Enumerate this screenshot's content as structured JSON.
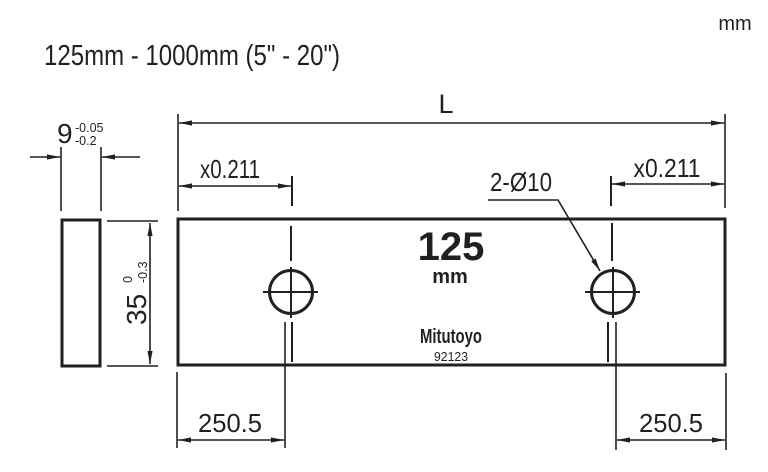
{
  "header": {
    "range_title": "125mm - 1000mm (5\" - 20\")",
    "unit_label": "mm"
  },
  "drawing": {
    "length_label": "L",
    "offset_left": "x0.211",
    "offset_right": "x0.211",
    "hole_callout": "2-Ø10",
    "hole_dist_left": "250.5",
    "hole_dist_right": "250.5",
    "thickness": {
      "value": "9",
      "tol_upper": "-0.05",
      "tol_lower": "-0.2"
    },
    "height": {
      "value": "35",
      "tol_upper": "0",
      "tol_lower": "-0.3"
    },
    "block_face": {
      "size": "125",
      "unit": "mm",
      "brand": "Mitutoyo",
      "code": "92123"
    }
  },
  "colors": {
    "ink": "#231f20",
    "background": "#ffffff"
  }
}
